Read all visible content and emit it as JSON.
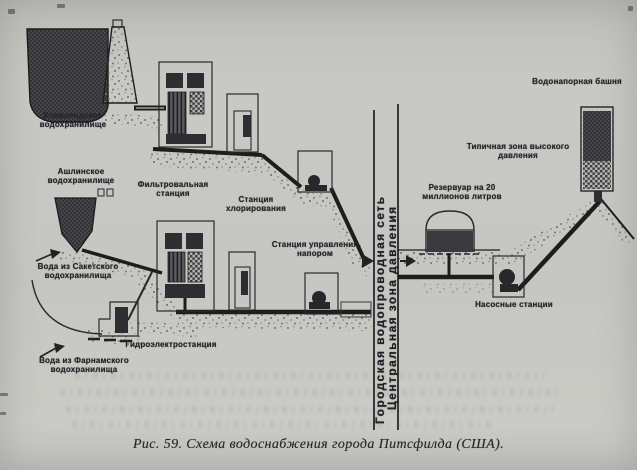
{
  "figure": {
    "caption": "Рис. 59. Схема водоснабжения города Питсфилда (США).",
    "labels": {
      "cleveland_reservoir": "Кливлендское водохранилище",
      "ashley_reservoir": "Ашлинское водохранилище",
      "filter_station": "Фильтровальная станция",
      "chlorination_station": "Станция хлорирования",
      "pressure_control_station": "Станция управления напором",
      "sackett_water": "Вода из Сакетского водохранилища",
      "farnham_water": "Вода из Фарнамского водохранилища",
      "hydro_station": "Гидроэлектростанция",
      "city_network": "Городская водопроводная сеть",
      "central_pressure_zone": "Центральная зона давления",
      "reservoir_20m": "Резервуар на 20 миллионов литров",
      "high_pressure_zone": "Типичная зона высокого давления",
      "water_tower": "Водонапорная башня",
      "pump_stations": "Насосные станции"
    },
    "ink_color": "#1d1d1d",
    "paper_color": "#c6c6c2"
  }
}
